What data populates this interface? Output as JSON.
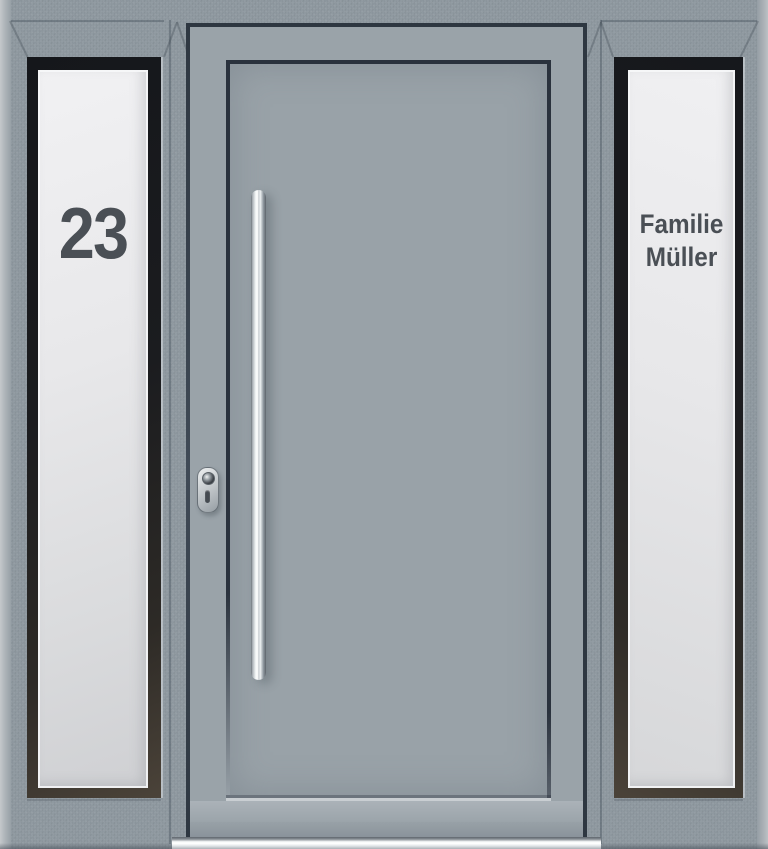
{
  "image": {
    "subject": "Modern grey aluminium front entrance door with two frosted-glass sidelights",
    "door_position": "center leaf, hinged right",
    "handle_type": "vertical stainless-steel bar pull handle",
    "lock_type": "oval security escutcheon with keyhole and cylinder slot",
    "threshold": "bright aluminium threshold strip under the door leaf"
  },
  "left_sidelight": {
    "glass_text": "23"
  },
  "right_sidelight": {
    "glass_text_line1": "Familie",
    "glass_text_line2": "Müller"
  },
  "colors": {
    "frame_grey": "#8F99A0",
    "leaf_grey": "#9AA3A9",
    "panel_grey": "#99A2A8",
    "shadow_gap_navy": "#2E3741",
    "glazing_bead_dark": "#1A1C20",
    "glazing_bead_bronze": "#4B4339",
    "glass_frost_light": "#F0F0F2",
    "glass_frost_dark": "#CFD0D3",
    "etched_text": "#4A4F55",
    "handle_steel_highlight": "#FFFFFF",
    "threshold_silver": "#F8FAFB"
  }
}
